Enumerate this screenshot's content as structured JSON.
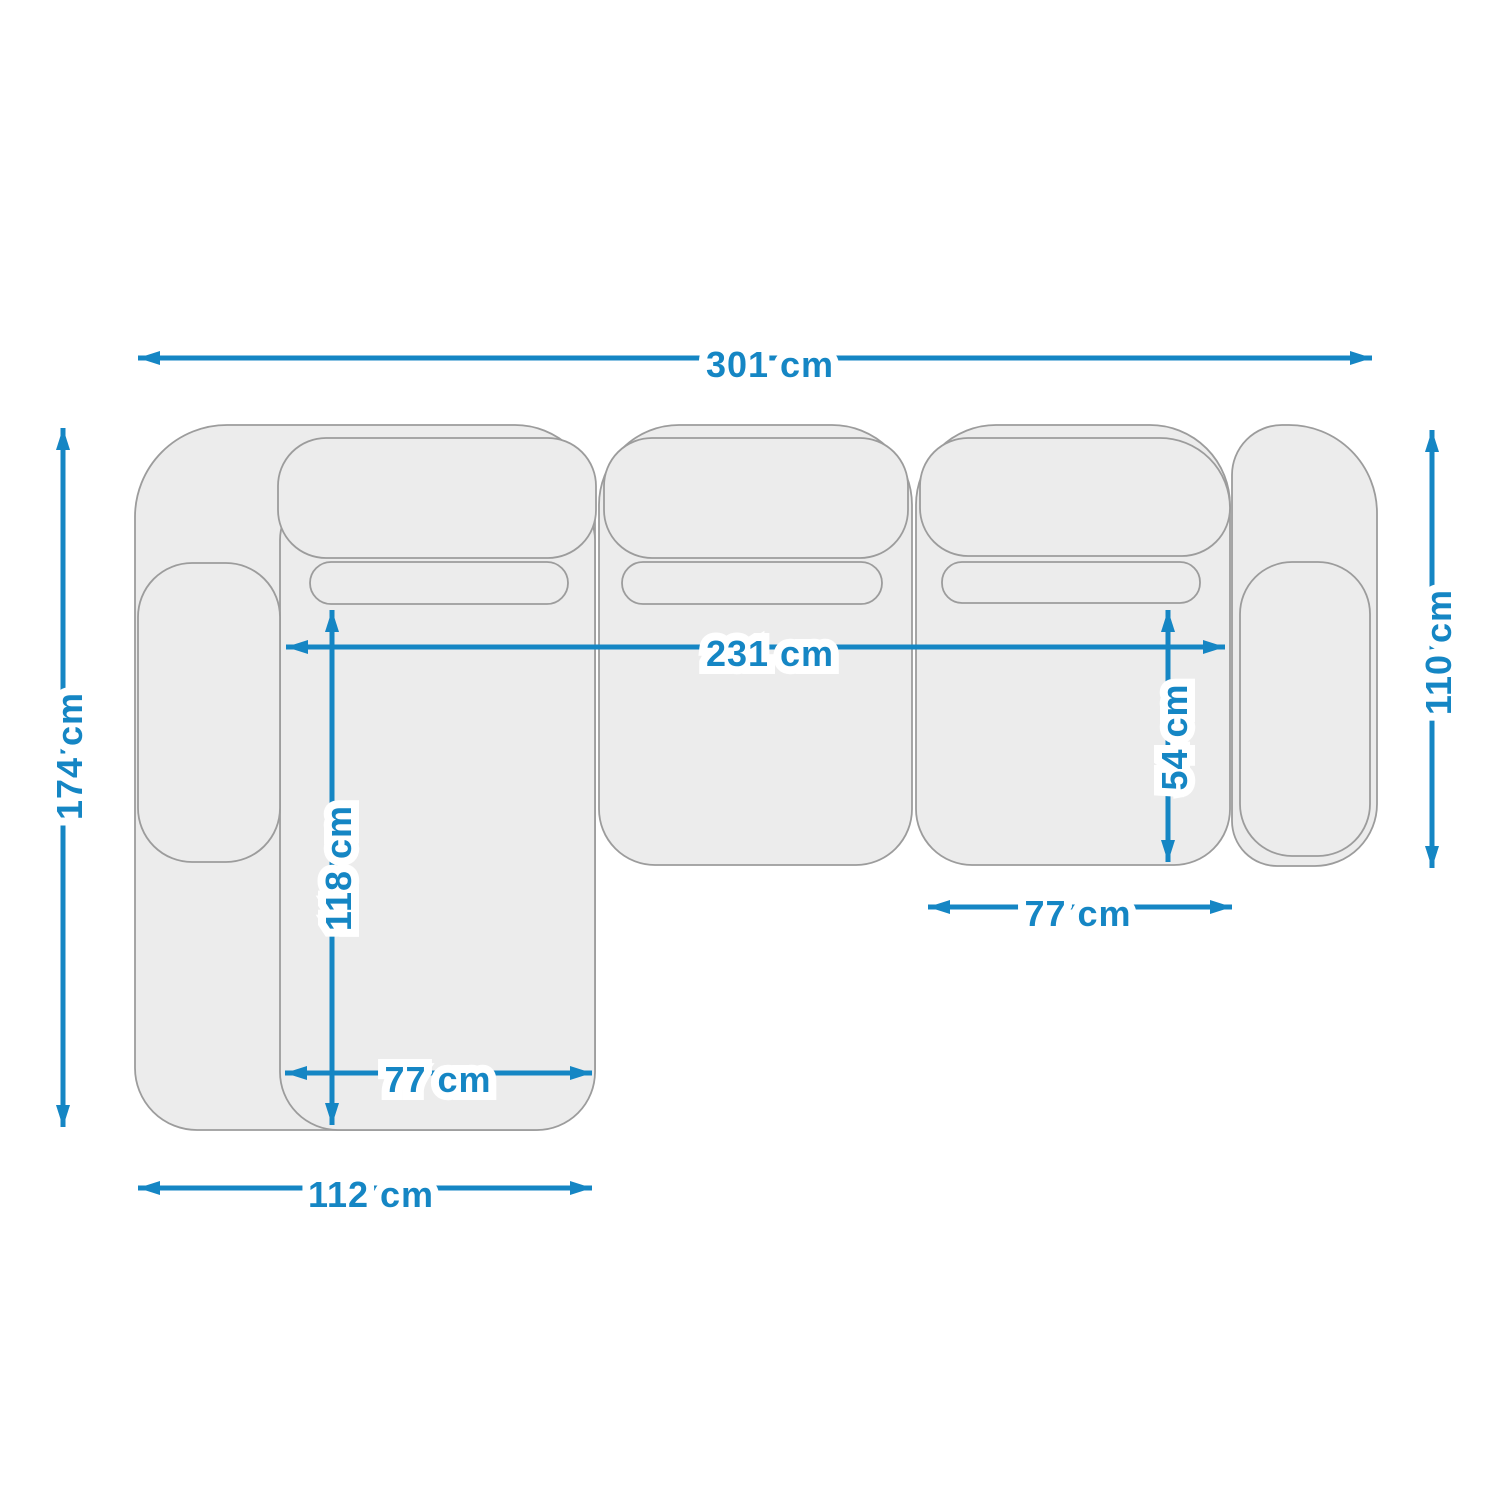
{
  "colors": {
    "dim": "#1586c4",
    "sofa-fill": "#ececec",
    "sofa-stroke": "#9c9c9c",
    "bg": "#ffffff"
  },
  "diagram": {
    "name": "corner-sofa-top-view-dimension-drawing",
    "unit": "cm",
    "dimensions": {
      "total_width": "301 cm",
      "total_depth": "174 cm",
      "right_side_depth": "110 cm",
      "inner_width": "231 cm",
      "chaise_inner_length": "118 cm",
      "seat_depth": "54 cm",
      "chaise_seat_width": "77 cm",
      "right_seat_width": "77 cm",
      "chaise_total_width": "112 cm"
    }
  }
}
